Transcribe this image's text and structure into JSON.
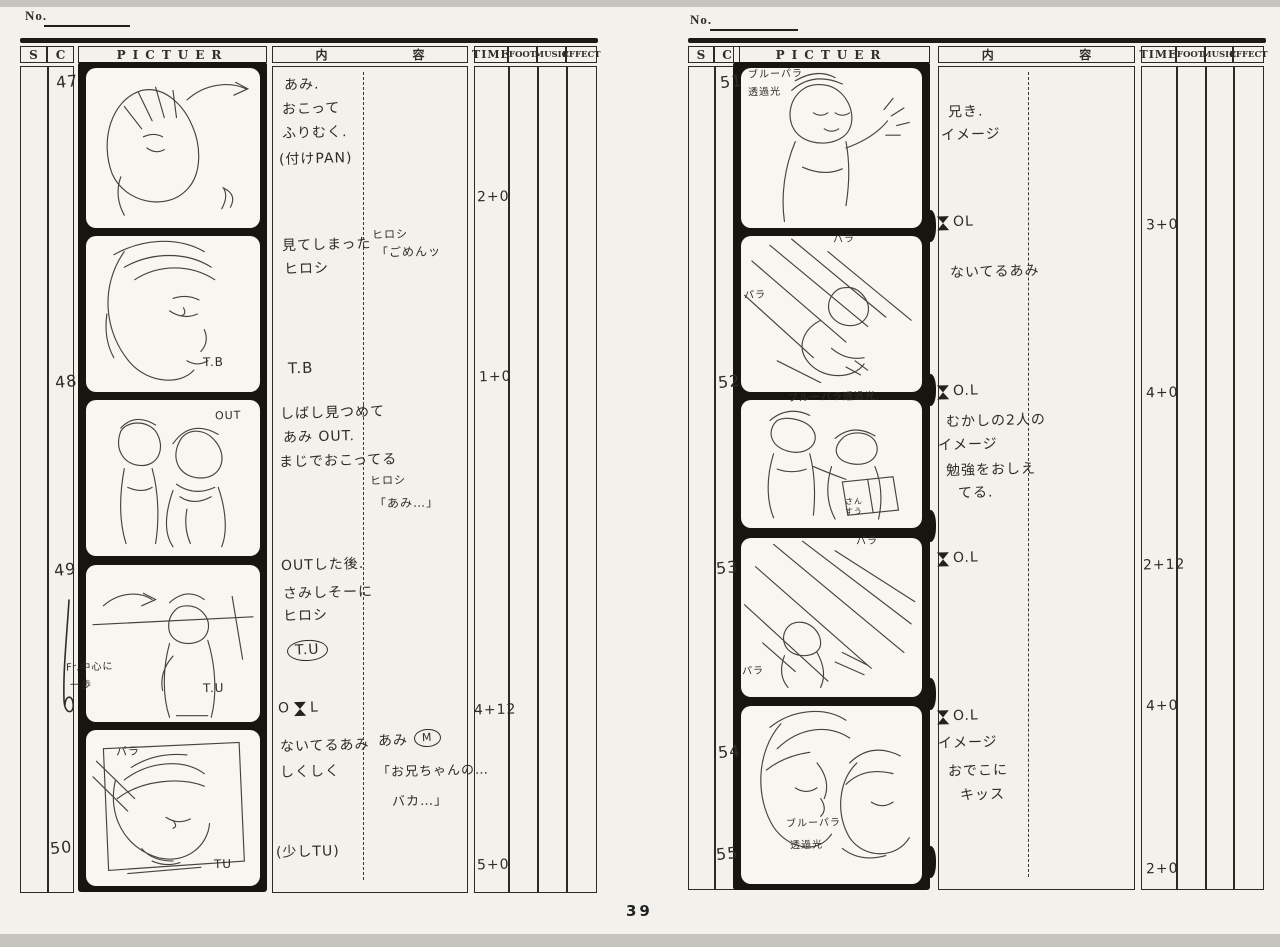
{
  "page": {
    "number": "39"
  },
  "colors": {
    "paper": "#f2f1ec",
    "ink": "#2b2a25",
    "film": "#17150f",
    "pencil": "#45433e"
  },
  "sheets": [
    {
      "side": "left",
      "no_label": "No.",
      "header": {
        "s": "S",
        "c": "C",
        "picture": "PICTUER",
        "content_left": "内",
        "content_right": "容",
        "time": "TIME",
        "foot": "FOOT",
        "music": "MUSIC",
        "effect": "EFFECT"
      },
      "rows": [
        {
          "number": "47",
          "num_x": 56,
          "num_y": 72,
          "sketch": "girl-glancing-back",
          "frame_notes": [],
          "notes": [
            {
              "t": "あみ.",
              "x": 284,
              "y": 78
            },
            {
              "t": "おこって",
              "x": 282,
              "y": 102
            },
            {
              "t": "ふりむく.",
              "x": 282,
              "y": 126
            },
            {
              "t": "(付けPAN)",
              "x": 279,
              "y": 152
            }
          ],
          "time": {
            "t": "2+0",
            "x": 477,
            "y": 190
          }
        },
        {
          "number": "48",
          "num_x": 55,
          "num_y": 372,
          "sketch": "face-closeup",
          "frame_notes": [
            {
              "t": "T.B",
              "x": 203,
              "y": 356,
              "size": 12
            }
          ],
          "notes": [
            {
              "t": "見てしまった",
              "x": 282,
              "y": 238
            },
            {
              "t": "ヒロシ",
              "x": 284,
              "y": 262
            },
            {
              "t": "ヒロシ",
              "x": 372,
              "y": 229,
              "size": 11
            },
            {
              "t": "「ごめんッ",
              "x": 376,
              "y": 246,
              "size": 12
            },
            {
              "t": "T.B",
              "x": 288,
              "y": 360,
              "size": 15
            }
          ],
          "time": {
            "t": "1+0",
            "x": 479,
            "y": 370
          }
        },
        {
          "number": "49",
          "num_x": 54,
          "num_y": 560,
          "sketch": "two-figures",
          "frame_notes": [
            {
              "t": "OUT",
              "x": 215,
              "y": 410,
              "size": 11
            }
          ],
          "notes": [
            {
              "t": "しばし見つめて",
              "x": 280,
              "y": 406
            },
            {
              "t": "あみ OUT.",
              "x": 283,
              "y": 430
            },
            {
              "t": "まじでおこってる",
              "x": 279,
              "y": 454
            },
            {
              "t": "ヒロシ",
              "x": 370,
              "y": 475,
              "size": 11
            },
            {
              "t": "「あみ…」",
              "x": 374,
              "y": 497,
              "size": 12
            }
          ],
          "time": null
        },
        {
          "cont_mark": true,
          "sketch": "figure-behind",
          "frame_notes": [
            {
              "t": "Fr.中心に",
              "x": 66,
              "y": 662,
              "size": 10
            },
            {
              "t": "一歩",
              "x": 70,
              "y": 680,
              "size": 10
            },
            {
              "t": "T.U",
              "x": 203,
              "y": 682,
              "size": 12
            }
          ],
          "notes": [
            {
              "t": "OUTした後.",
              "x": 281,
              "y": 558
            },
            {
              "t": "さみしそーに",
              "x": 283,
              "y": 586
            },
            {
              "t": "ヒロシ",
              "x": 283,
              "y": 609
            },
            {
              "t": "T.U",
              "x": 287,
              "y": 640,
              "circle": true
            },
            {
              "t": "OL",
              "x": 278,
              "y": 701,
              "ol": "mid"
            }
          ],
          "time": {
            "t": "4+12",
            "x": 474,
            "y": 703
          }
        },
        {
          "number": "50",
          "num_x": 50,
          "num_y": 838,
          "sketch": "tv-face",
          "frame_notes": [
            {
              "t": "パラ",
              "x": 116,
              "y": 746,
              "size": 11
            },
            {
              "t": "TU",
              "x": 214,
              "y": 858,
              "size": 12
            }
          ],
          "notes": [
            {
              "t": "ないてるあみ",
              "x": 280,
              "y": 739
            },
            {
              "t": "しくしく",
              "x": 280,
              "y": 765
            },
            {
              "t": "あみ",
              "x": 378,
              "y": 734
            },
            {
              "t": "M",
              "x": 414,
              "y": 729,
              "circle": true,
              "size": 11
            },
            {
              "t": "「お兄ちゃんの…",
              "x": 377,
              "y": 765,
              "size": 13
            },
            {
              "t": "バカ…」",
              "x": 392,
              "y": 795,
              "size": 13
            },
            {
              "t": "(少しTU)",
              "x": 276,
              "y": 845
            }
          ],
          "time": {
            "t": "5+0",
            "x": 477,
            "y": 858
          }
        }
      ]
    },
    {
      "side": "right",
      "no_label": "No.",
      "header": {
        "s": "S",
        "c": "C",
        "picture": "PICTUER",
        "content_left": "内",
        "content_right": "容",
        "time": "TIME",
        "foot": "FOOT",
        "music": "MUSIC",
        "effect": "EFFECT"
      },
      "rows": [
        {
          "number": "51",
          "num_x": 720,
          "num_y": 72,
          "sketch": "boy-waving",
          "frame_notes": [
            {
              "t": "ブルーパラ",
              "x": 748,
              "y": 69,
              "size": 10
            },
            {
              "t": "透過光",
              "x": 748,
              "y": 87,
              "size": 10
            }
          ],
          "notes": [
            {
              "t": "兄き.",
              "x": 948,
              "y": 105
            },
            {
              "t": "イメージ",
              "x": 941,
              "y": 128
            },
            {
              "t": "OL",
              "x": 936,
              "y": 215,
              "ol": "before"
            }
          ],
          "time": {
            "t": "3+0",
            "x": 1146,
            "y": 218
          }
        },
        {
          "number": "52",
          "num_x": 718,
          "num_y": 372,
          "sketch": "lying-figure-rays",
          "frame_notes": [
            {
              "t": "パラ",
              "x": 833,
              "y": 234,
              "size": 10
            },
            {
              "t": "パラ",
              "x": 744,
              "y": 290,
              "size": 10
            }
          ],
          "notes": [
            {
              "t": "ないてるあみ",
              "x": 950,
              "y": 265
            },
            {
              "t": "O.L",
              "x": 936,
              "y": 384,
              "ol": "before"
            }
          ],
          "time": {
            "t": "4+0",
            "x": 1146,
            "y": 386
          }
        },
        {
          "number": "53",
          "num_x": 716,
          "num_y": 558,
          "sketch": "two-kids-book",
          "frame_notes": [
            {
              "t": "ブルーパラ透過光.",
              "x": 788,
              "y": 392,
              "size": 10
            },
            {
              "t": "さん",
              "x": 845,
              "y": 498,
              "size": 8
            },
            {
              "t": "すう",
              "x": 845,
              "y": 508,
              "size": 8
            }
          ],
          "notes": [
            {
              "t": "むかしの2人の",
              "x": 946,
              "y": 414
            },
            {
              "t": "イメージ",
              "x": 938,
              "y": 438
            },
            {
              "t": "勉強をおしえ",
              "x": 946,
              "y": 463
            },
            {
              "t": "てる.",
              "x": 958,
              "y": 486
            },
            {
              "t": "O.L",
              "x": 936,
              "y": 551,
              "ol": "before"
            }
          ],
          "time": {
            "t": "2+12",
            "x": 1143,
            "y": 558
          }
        },
        {
          "number": "54",
          "num_x": 718,
          "num_y": 742,
          "sketch": "diagonal-rays-figure",
          "frame_notes": [
            {
              "t": "パラ",
              "x": 856,
              "y": 536,
              "size": 10
            },
            {
              "t": "パラ",
              "x": 742,
              "y": 666,
              "size": 10
            }
          ],
          "notes": [
            {
              "t": "O.L",
              "x": 936,
              "y": 709,
              "ol": "before"
            }
          ],
          "time": {
            "t": "4+0",
            "x": 1146,
            "y": 699
          }
        },
        {
          "number": "55",
          "num_x": 716,
          "num_y": 844,
          "sketch": "two-faces-kiss",
          "frame_notes": [
            {
              "t": "ブルーパラ",
              "x": 786,
              "y": 818,
              "size": 10
            },
            {
              "t": "透過光",
              "x": 790,
              "y": 840,
              "size": 10
            }
          ],
          "notes": [
            {
              "t": "イメージ",
              "x": 938,
              "y": 736
            },
            {
              "t": "おでこに",
              "x": 948,
              "y": 764
            },
            {
              "t": "キッス",
              "x": 960,
              "y": 788
            }
          ],
          "time": {
            "t": "2+0",
            "x": 1146,
            "y": 862
          }
        }
      ]
    }
  ]
}
